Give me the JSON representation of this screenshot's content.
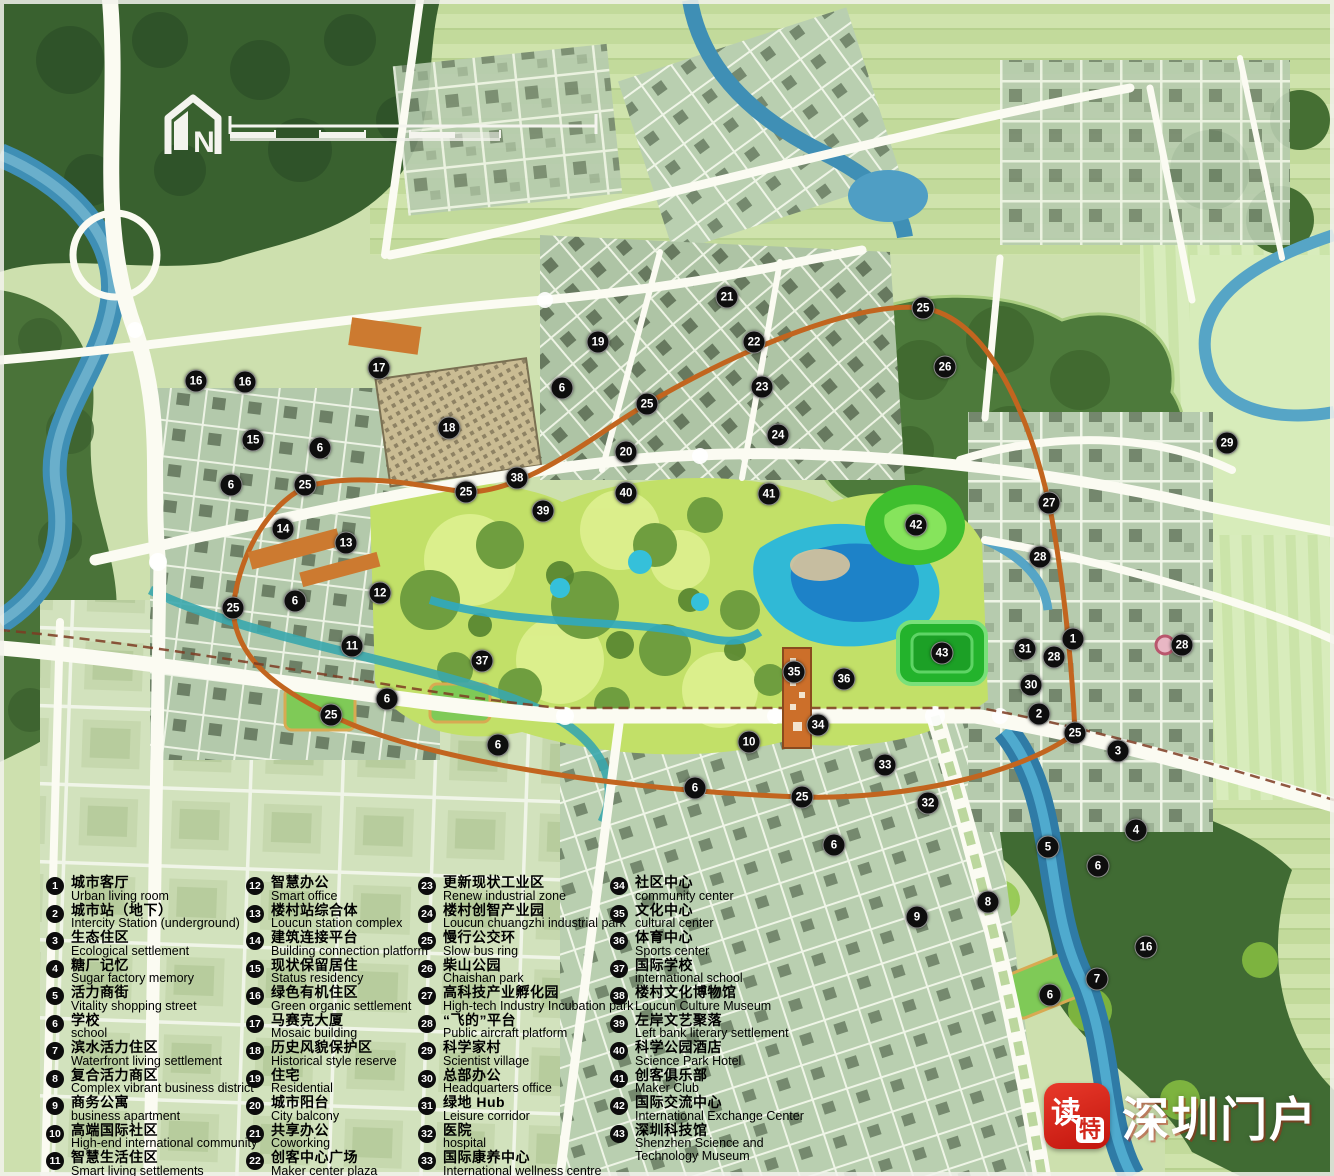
{
  "map": {
    "compass_label": "N",
    "marker_color": "#0e0e0e",
    "ring_road_color": "#c2651f",
    "water_color": "#3f8fb5",
    "park_color": "#c2e068"
  },
  "watermark": {
    "app_name_chars": [
      "读",
      "特"
    ],
    "site_name": "深圳门户"
  },
  "legend": {
    "items": [
      {
        "num": "1",
        "cn": "城市客厅",
        "en": "Urban living room",
        "col": 0
      },
      {
        "num": "2",
        "cn": "城市站（地下）",
        "en": "Intercity Station (underground)",
        "col": 0
      },
      {
        "num": "3",
        "cn": "生态住区",
        "en": "Ecological settlement",
        "col": 0
      },
      {
        "num": "4",
        "cn": "糖厂记忆",
        "en": "Sugar factory memory",
        "col": 0
      },
      {
        "num": "5",
        "cn": "活力商街",
        "en": "Vitality shopping street",
        "col": 0
      },
      {
        "num": "6",
        "cn": "学校",
        "en": "school",
        "col": 0
      },
      {
        "num": "7",
        "cn": "滨水活力住区",
        "en": "Waterfront living settlement",
        "col": 0
      },
      {
        "num": "8",
        "cn": "复合活力商区",
        "en": "Complex vibrant business district",
        "col": 0
      },
      {
        "num": "9",
        "cn": "商务公寓",
        "en": "business apartment",
        "col": 0
      },
      {
        "num": "10",
        "cn": "高端国际社区",
        "en": "High-end international community",
        "col": 0
      },
      {
        "num": "11",
        "cn": "智慧生活住区",
        "en": "Smart living settlements",
        "col": 0
      },
      {
        "num": "12",
        "cn": "智慧办公",
        "en": "Smart office",
        "col": 1
      },
      {
        "num": "13",
        "cn": "楼村站综合体",
        "en": "Loucun station complex",
        "col": 1
      },
      {
        "num": "14",
        "cn": "建筑连接平台",
        "en": "Building connection platform",
        "col": 1
      },
      {
        "num": "15",
        "cn": "现状保留居住",
        "en": "Status residency",
        "col": 1
      },
      {
        "num": "16",
        "cn": "绿色有机住区",
        "en": "Green organic settlement",
        "col": 1
      },
      {
        "num": "17",
        "cn": "马赛克大厦",
        "en": "Mosaic building",
        "col": 1
      },
      {
        "num": "18",
        "cn": "历史风貌保护区",
        "en": "Historical style reserve",
        "col": 1
      },
      {
        "num": "19",
        "cn": "住宅",
        "en": "Residential",
        "col": 1
      },
      {
        "num": "20",
        "cn": "城市阳台",
        "en": "City balcony",
        "col": 1
      },
      {
        "num": "21",
        "cn": "共享办公",
        "en": "Coworking",
        "col": 1
      },
      {
        "num": "22",
        "cn": "创客中心广场",
        "en": "Maker center plaza",
        "col": 1
      },
      {
        "num": "23",
        "cn": "更新现状工业区",
        "en": "Renew industrial zone",
        "col": 2
      },
      {
        "num": "24",
        "cn": "楼村创智产业园",
        "en": "Loucun chuangzhi industrial park",
        "col": 2
      },
      {
        "num": "25",
        "cn": "慢行公交环",
        "en": "Slow bus ring",
        "col": 2
      },
      {
        "num": "26",
        "cn": "柴山公园",
        "en": "Chaishan park",
        "col": 2
      },
      {
        "num": "27",
        "cn": "高科技产业孵化园",
        "en": "High-tech Industry Incubation park",
        "col": 2
      },
      {
        "num": "28",
        "cn": "“飞的”平台",
        "en": "Public aircraft platform",
        "col": 2
      },
      {
        "num": "29",
        "cn": "科学家村",
        "en": "Scientist village",
        "col": 2
      },
      {
        "num": "30",
        "cn": "总部办公",
        "en": "Headquarters office",
        "col": 2
      },
      {
        "num": "31",
        "cn": "绿地 Hub",
        "en": "Leisure corridor",
        "col": 2
      },
      {
        "num": "32",
        "cn": "医院",
        "en": "hospital",
        "col": 2
      },
      {
        "num": "33",
        "cn": "国际康养中心",
        "en": "International wellness centre",
        "col": 2
      },
      {
        "num": "34",
        "cn": "社区中心",
        "en": "community center",
        "col": 3
      },
      {
        "num": "35",
        "cn": "文化中心",
        "en": "cultural center",
        "col": 3
      },
      {
        "num": "36",
        "cn": "体育中心",
        "en": "Sports center",
        "col": 3
      },
      {
        "num": "37",
        "cn": "国际学校",
        "en": "international school",
        "col": 3
      },
      {
        "num": "38",
        "cn": "楼村文化博物馆",
        "en": "Loucun Culture Museum",
        "col": 3
      },
      {
        "num": "39",
        "cn": "左岸文艺聚落",
        "en": "Left bank literary settlement",
        "col": 3
      },
      {
        "num": "40",
        "cn": "科学公园酒店",
        "en": "Science Park Hotel",
        "col": 3
      },
      {
        "num": "41",
        "cn": "创客俱乐部",
        "en": "Maker Club",
        "col": 3
      },
      {
        "num": "42",
        "cn": "国际交流中心",
        "en": "International Exchange Center",
        "col": 3
      },
      {
        "num": "43",
        "cn": "深圳科技馆",
        "en": "Shenzhen Science and",
        "en2": "Technology Museum",
        "col": 3
      }
    ]
  },
  "markers": [
    {
      "n": "16",
      "x": 196,
      "y": 381
    },
    {
      "n": "16",
      "x": 245,
      "y": 382
    },
    {
      "n": "17",
      "x": 379,
      "y": 368
    },
    {
      "n": "18",
      "x": 449,
      "y": 428
    },
    {
      "n": "15",
      "x": 253,
      "y": 440
    },
    {
      "n": "6",
      "x": 320,
      "y": 448
    },
    {
      "n": "6",
      "x": 231,
      "y": 485
    },
    {
      "n": "25",
      "x": 305,
      "y": 485
    },
    {
      "n": "14",
      "x": 283,
      "y": 529
    },
    {
      "n": "13",
      "x": 346,
      "y": 543
    },
    {
      "n": "12",
      "x": 380,
      "y": 593
    },
    {
      "n": "6",
      "x": 295,
      "y": 601
    },
    {
      "n": "25",
      "x": 233,
      "y": 608
    },
    {
      "n": "11",
      "x": 352,
      "y": 646
    },
    {
      "n": "37",
      "x": 482,
      "y": 661
    },
    {
      "n": "6",
      "x": 387,
      "y": 699
    },
    {
      "n": "25",
      "x": 331,
      "y": 715
    },
    {
      "n": "6",
      "x": 498,
      "y": 745
    },
    {
      "n": "19",
      "x": 598,
      "y": 342
    },
    {
      "n": "21",
      "x": 727,
      "y": 297
    },
    {
      "n": "22",
      "x": 754,
      "y": 342
    },
    {
      "n": "23",
      "x": 762,
      "y": 387
    },
    {
      "n": "24",
      "x": 778,
      "y": 435
    },
    {
      "n": "25",
      "x": 647,
      "y": 404
    },
    {
      "n": "6",
      "x": 562,
      "y": 388
    },
    {
      "n": "20",
      "x": 626,
      "y": 452
    },
    {
      "n": "38",
      "x": 517,
      "y": 478
    },
    {
      "n": "25",
      "x": 466,
      "y": 492
    },
    {
      "n": "39",
      "x": 543,
      "y": 511
    },
    {
      "n": "40",
      "x": 626,
      "y": 493
    },
    {
      "n": "41",
      "x": 769,
      "y": 494
    },
    {
      "n": "25",
      "x": 923,
      "y": 308
    },
    {
      "n": "26",
      "x": 945,
      "y": 367
    },
    {
      "n": "42",
      "x": 916,
      "y": 525
    },
    {
      "n": "27",
      "x": 1049,
      "y": 503
    },
    {
      "n": "28",
      "x": 1040,
      "y": 557
    },
    {
      "n": "29",
      "x": 1227,
      "y": 443
    },
    {
      "n": "1",
      "x": 1073,
      "y": 639
    },
    {
      "n": "31",
      "x": 1025,
      "y": 649
    },
    {
      "n": "28",
      "x": 1182,
      "y": 645
    },
    {
      "n": "28",
      "x": 1054,
      "y": 657
    },
    {
      "n": "30",
      "x": 1031,
      "y": 685
    },
    {
      "n": "2",
      "x": 1039,
      "y": 714
    },
    {
      "n": "25",
      "x": 1075,
      "y": 733
    },
    {
      "n": "3",
      "x": 1118,
      "y": 751
    },
    {
      "n": "43",
      "x": 942,
      "y": 653
    },
    {
      "n": "35",
      "x": 794,
      "y": 672
    },
    {
      "n": "36",
      "x": 844,
      "y": 679
    },
    {
      "n": "34",
      "x": 818,
      "y": 725
    },
    {
      "n": "10",
      "x": 749,
      "y": 742
    },
    {
      "n": "33",
      "x": 885,
      "y": 765
    },
    {
      "n": "6",
      "x": 695,
      "y": 788
    },
    {
      "n": "25",
      "x": 802,
      "y": 797
    },
    {
      "n": "32",
      "x": 928,
      "y": 803
    },
    {
      "n": "6",
      "x": 834,
      "y": 845
    },
    {
      "n": "9",
      "x": 917,
      "y": 917
    },
    {
      "n": "8",
      "x": 988,
      "y": 902
    },
    {
      "n": "4",
      "x": 1136,
      "y": 830
    },
    {
      "n": "5",
      "x": 1048,
      "y": 847
    },
    {
      "n": "6",
      "x": 1098,
      "y": 866
    },
    {
      "n": "16",
      "x": 1146,
      "y": 947
    },
    {
      "n": "7",
      "x": 1097,
      "y": 979
    },
    {
      "n": "6",
      "x": 1050,
      "y": 995
    }
  ]
}
